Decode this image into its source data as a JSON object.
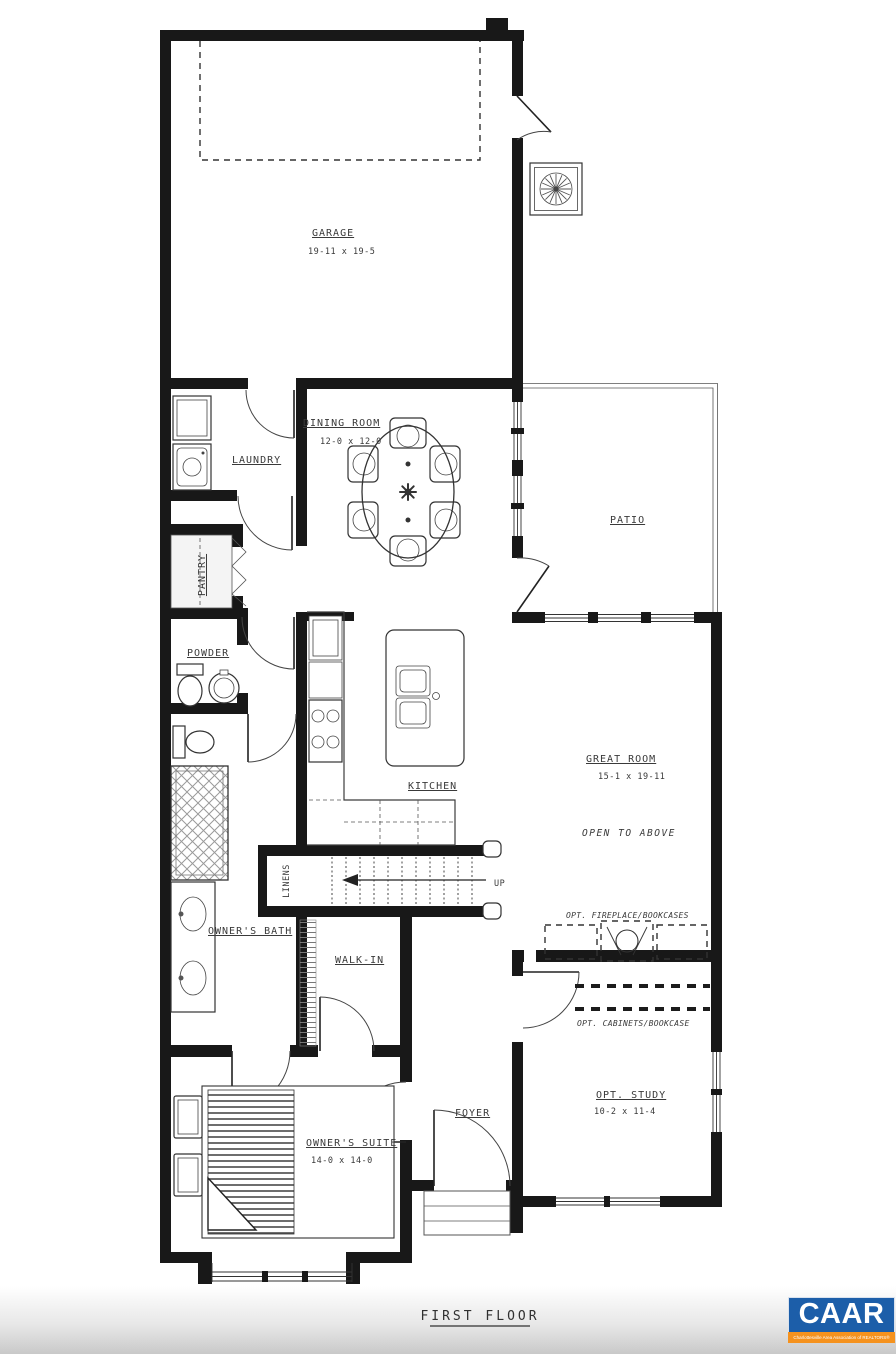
{
  "plan": {
    "title": "FIRST FLOOR",
    "rooms": {
      "garage": {
        "name": "GARAGE",
        "dims": "19-11 x 19-5"
      },
      "dining": {
        "name": "DINING ROOM",
        "dims": "12-0 x 12-0"
      },
      "laundry": {
        "name": "LAUNDRY"
      },
      "pantry": {
        "name": "PANTRY"
      },
      "powder": {
        "name": "POWDER"
      },
      "patio": {
        "name": "PATIO"
      },
      "kitchen": {
        "name": "KITCHEN"
      },
      "great_room": {
        "name": "GREAT ROOM",
        "dims": "15-1 x 19-11",
        "note": "OPEN TO ABOVE"
      },
      "owners_bath": {
        "name": "OWNER'S BATH"
      },
      "linens": {
        "name": "LINENS"
      },
      "walk_in": {
        "name": "WALK-IN"
      },
      "foyer": {
        "name": "FOYER"
      },
      "owners_suite": {
        "name": "OWNER'S SUITE",
        "dims": "14-0 x 14-0"
      },
      "opt_study": {
        "name": "OPT. STUDY",
        "dims": "10-2 x 11-4"
      }
    },
    "annotations": {
      "stairs_up": "UP",
      "opt_fireplace": "OPT. FIREPLACE/BOOKCASES",
      "opt_cabinets": "OPT. CABINETS/BOOKCASE"
    },
    "colors": {
      "wall": "#181818",
      "line": "#3c3c3c",
      "background": "#ffffff"
    }
  },
  "logo": {
    "text": "CAAR",
    "tagline": "Charlottesville Area Association of REALTORS®",
    "colors": {
      "background": "#1c5ea9",
      "bar": "#f5921e",
      "text": "#ffffff"
    }
  }
}
